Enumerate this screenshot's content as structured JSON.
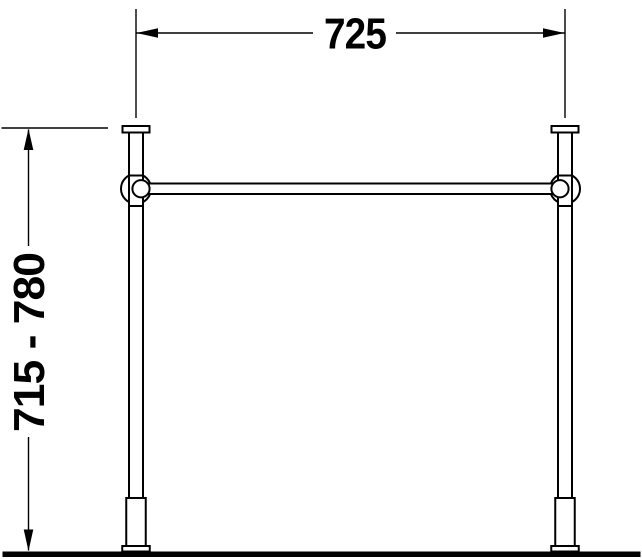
{
  "page": {
    "background_color": "#ffffff",
    "line_color": "#000000"
  },
  "drawing": {
    "description": "technical elevation drawing of a two-leg metal console stand with horizontal crossbar, adjustable feet and ground line"
  },
  "dimensions": {
    "width_mm": "725",
    "height_range_mm": "715 - 780"
  }
}
